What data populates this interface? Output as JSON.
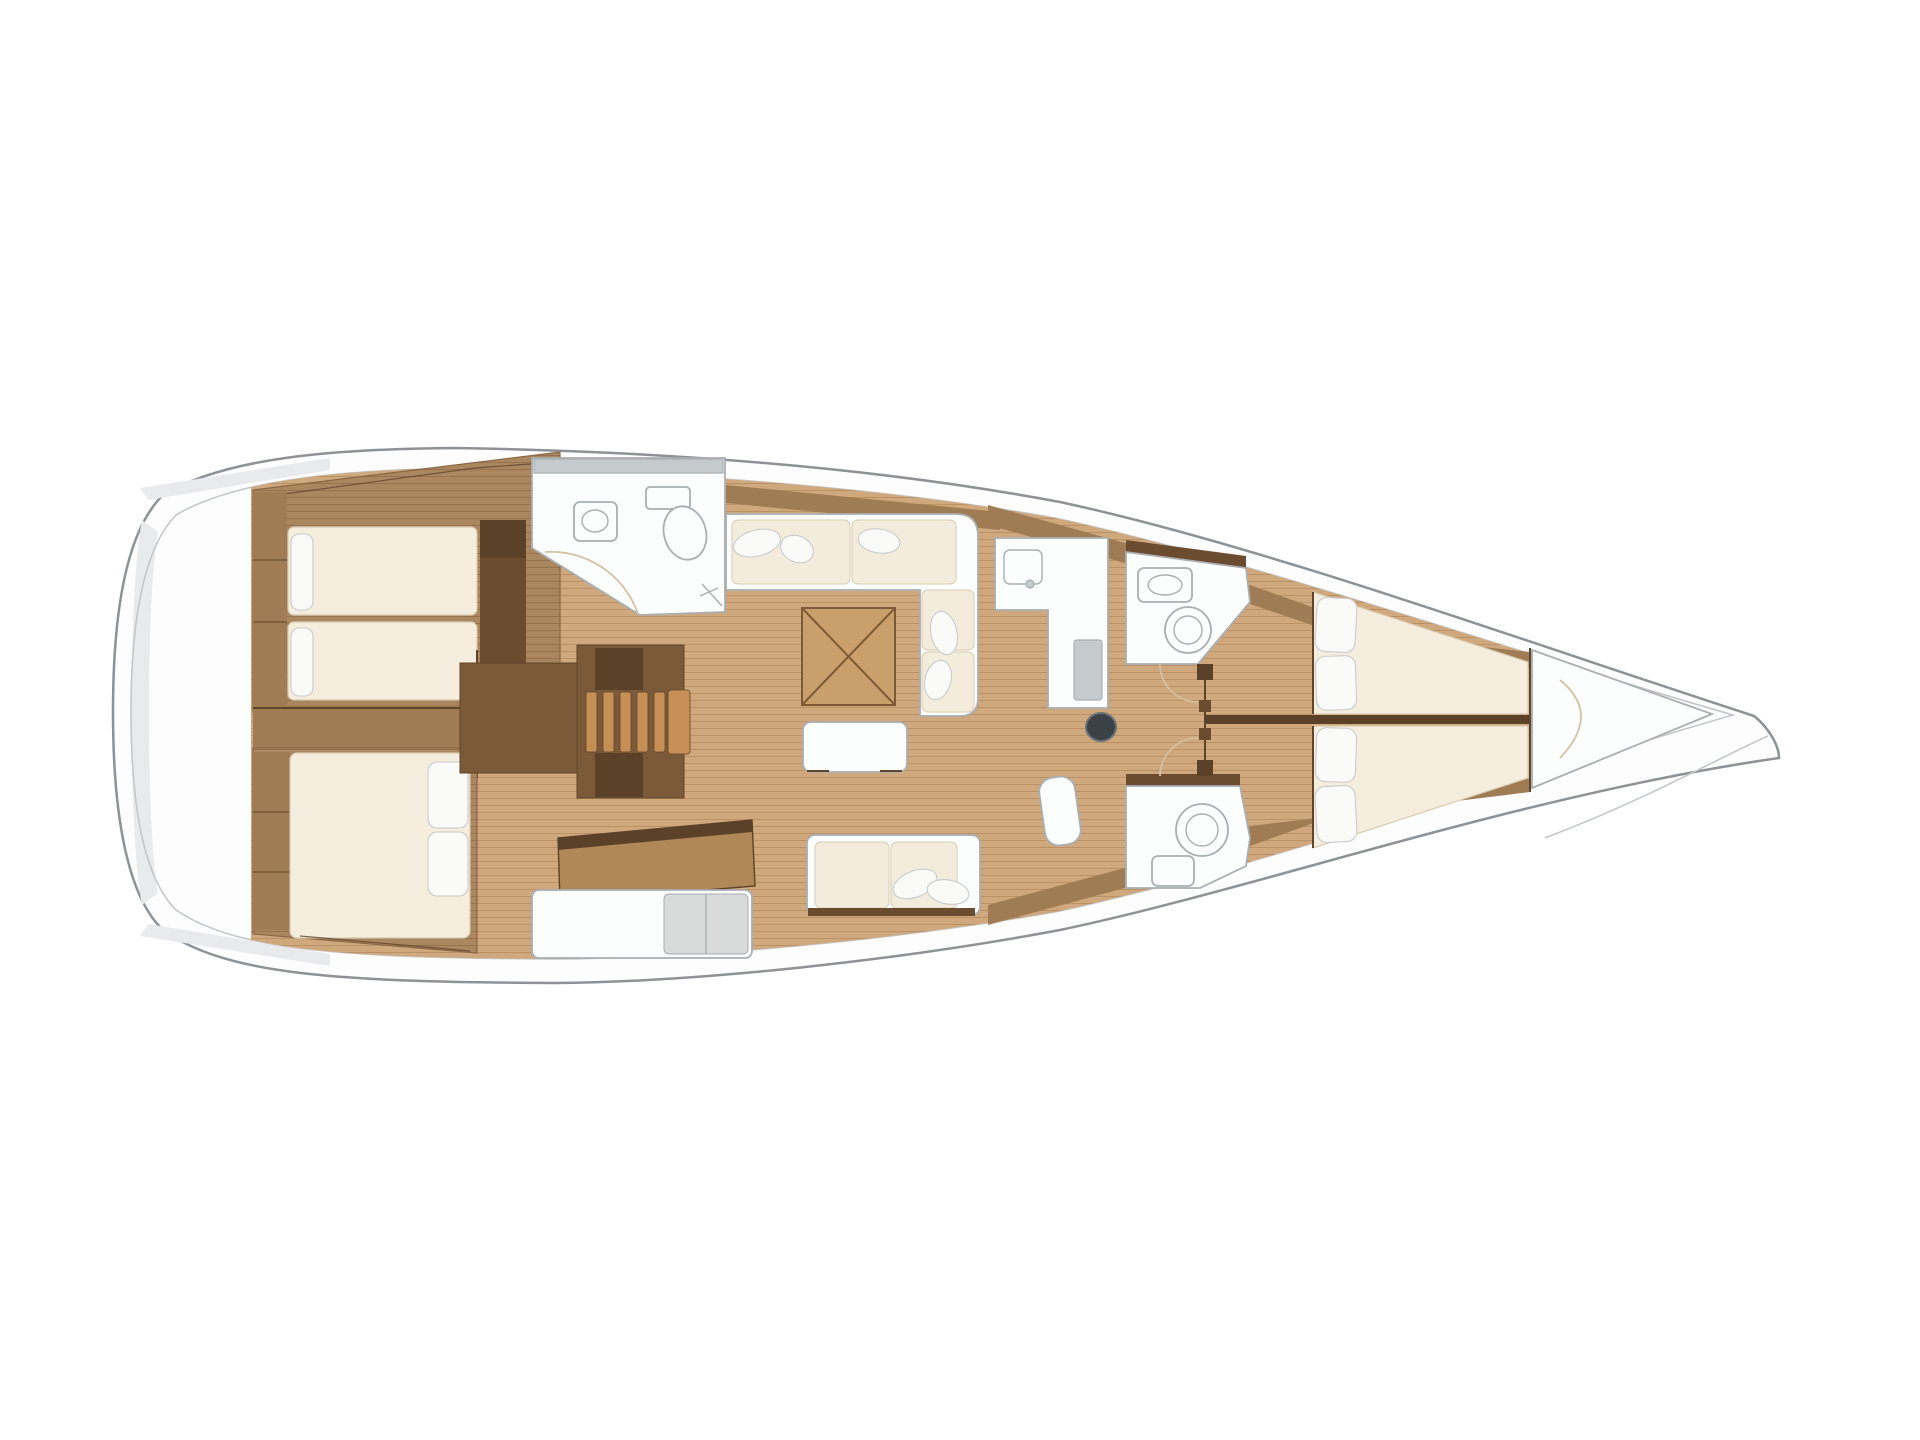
{
  "meta": {
    "description": "Sailing yacht interior layout floor plan, top-down view: two aft cabins with berths, companionway stairs, aft head, saloon with L-shaped sofa, folding table, bench and settee, chart table, galley, mast, two forward heads, V-berth forward cabin and bow locker",
    "canvas": {
      "width": 1920,
      "height": 1440
    }
  },
  "palette": {
    "bg": "#ffffff",
    "hull-fill": "#fdfdfd",
    "hull-outline": "#8c9296",
    "inner-line": "#c3c7c9",
    "deck-shade": "#e8eaeb",
    "wood-light": "#cfa87d",
    "wood-light-line": "#bb9266",
    "wood-mid": "#ab8760",
    "wood-mid-line": "#96734e",
    "wood-band": "#a07c54",
    "walnut": "#6b4c2e",
    "walnut-deep": "#5a4128",
    "stair-base": "#7b5a39",
    "tread": "#c68f55",
    "mattress": "#f5eddd",
    "mattress-edge": "#d8cbb2",
    "pillow": "#fafaf9",
    "pillow-edge": "#c9ccce",
    "cream-cushion": "#f3ecdd",
    "white-fix": "#fcfdfd",
    "fixture-outline": "#a9aeb1",
    "gray-inset": "#c5cacc",
    "cushion-gray": "#d9dbdb",
    "mast": "#3a4147",
    "mast-ring": "#6a7178",
    "table-wood": "#c9a06b",
    "table-line": "#7d5a35",
    "structure-line": "#5f452b",
    "door-arc": "#d3c1a4"
  },
  "regions": [
    "hull",
    "stern-lazarette",
    "aft-cabin-port",
    "aft-cabin-starboard",
    "companionway-stairs",
    "aft-head",
    "salon",
    "saloon-table",
    "galley",
    "chart-table",
    "mast",
    "forward-head-port",
    "forward-head-starboard",
    "corridor",
    "forward-cabin-vberth",
    "bow-locker"
  ]
}
